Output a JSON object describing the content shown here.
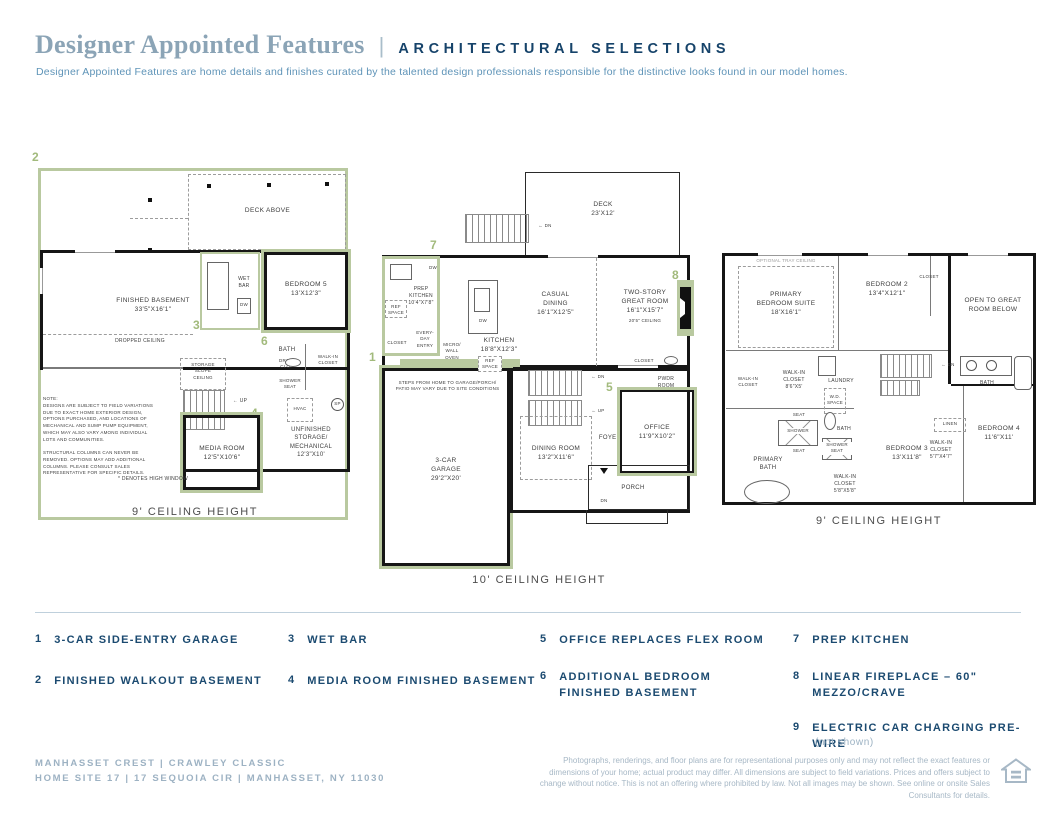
{
  "colors": {
    "accent_green": "#b9c9a0",
    "navy": "#1b4a70",
    "title_blue": "#8ba4b6",
    "footer_blue": "#9db2c3"
  },
  "header": {
    "title": "Designer Appointed Features",
    "separator": "|",
    "tagline": "ARCHITECTURAL SELECTIONS",
    "description": "Designer Appointed Features are home details and finishes curated by the talented design professionals responsible for the distinctive looks found in our model homes."
  },
  "basement": {
    "marker_finished_walkout": "2",
    "marker_wet_bar": "3",
    "marker_media_room": "4",
    "marker_bedroom": "6",
    "deck_above": "DECK ABOVE",
    "finished_basement": "FINISHED BASEMENT\n33'5\"X16'1\"",
    "dropped_ceiling": "DROPPED CEILING",
    "wet_bar": "WET\nBAR",
    "dw": "DW",
    "bedroom5": "BEDROOM 5\n13'X12'3\"",
    "bath": "BATH",
    "drop_clo": "DROP\nCLO.",
    "shower_seat": "SHOWER\nSEAT",
    "walk_in_closet": "WALK-IN\nCLOSET",
    "storage_slope_ceiling": "STORAGE\nSLOPE\nCEILING",
    "up": "← UP",
    "hvac": "HVAC",
    "sp": "SP",
    "unfinished": "UNFINISHED\nSTORAGE/\nMECHANICAL\n12'3\"X10'",
    "media_room": "MEDIA ROOM\n12'5\"X10'6\"",
    "note": "NOTE:\nDESIGNS ARE SUBJECT TO FIELD VARIATIONS\nDUE TO EXACT HOME EXTERIOR DESIGN,\nOPTIONS PURCHASED, AND LOCATIONS OF\nMECHANICAL AND SUMP PUMP EQUIPMENT,\nWHICH MAY ALSO VARY AMONG INDIVIDUAL\nLOTS AND COMMUNITIES.\n\nSTRUCTURAL COLUMNS CAN NEVER BE\nREMOVED. OPTIONS MAY ADD ADDITIONAL\nCOLUMNS. PLEASE CONSULT SALES\nREPRESENTATIVE FOR SPECIFIC DETAILS.",
    "high_window": "* DENOTES HIGH WINDOW",
    "ceiling_height": "9' CEILING HEIGHT"
  },
  "first_floor": {
    "marker_garage": "1",
    "marker_office": "5",
    "marker_prep_kitchen": "7",
    "marker_fireplace": "8",
    "deck": "DECK\n23'X12'",
    "dn": "← DN",
    "prep_kitchen": "PREP\nKITCHEN\n10'4\"X7'8\"",
    "ref_space": "REF\nSPACE",
    "dw": "DW",
    "casual_dining": "CASUAL\nDINING\n16'1\"X12'5\"",
    "great_room": "TWO-STORY\nGREAT ROOM\n16'1\"X15'7\"",
    "great_room_ceiling": "20'5\" CEILING",
    "closet": "CLOSET",
    "everyday_entry": "EVERY-\nDAY\nENTRY",
    "micro_wall_oven": "MICRO/\nWALL\nOVEN",
    "kitchen": "KITCHEN\n18'8\"X12'3\"",
    "steps_note": "STEPS FROM HOME TO GARAGE/PORCH/\nPATIO MAY VARY DUE TO SITE CONDITIONS",
    "garage": "3-CAR\nGARAGE\n29'2\"X20'",
    "up": "← UP",
    "dining_room": "DINING ROOM\n13'2\"X11'6\"",
    "foyer": "FOYER",
    "pwdr_room": "PWDR\nROOM",
    "office": "OFFICE\n11'9\"X10'2\"",
    "porch": "PORCH",
    "porch_dn": "DN",
    "ceiling_height": "10' CEILING HEIGHT"
  },
  "second_floor": {
    "optional_tray": "OPTIONAL TRAY CEILING",
    "primary_suite": "PRIMARY\nBEDROOM SUITE\n18'X16'1\"",
    "bedroom2": "BEDROOM 2\n13'4\"X12'1\"",
    "closet": "CLOSET",
    "open_to_great": "OPEN TO GREAT\nROOM BELOW",
    "dn": "← DN",
    "walk_in_closet": "WALK-IN\nCLOSET",
    "walk_in_closet_86": "WALK-IN\nCLOSET\n8'6\"X5'",
    "laundry": "LAUNDRY",
    "wd_space": "W.D.\nSPACE",
    "seat": "SEAT",
    "shower": "SHOWER",
    "bath": "BATH",
    "shower_seat": "SHOWER\nSEAT",
    "primary_bath": "PRIMARY\nBATH",
    "bedroom3": "BEDROOM 3\n13'X11'8\"",
    "walk_in_closet_58": "WALK-IN\nCLOSET\n5'8\"X5'8\"",
    "linen": "LINEN",
    "walk_in_closet_57": "WALK-IN\nCLOSET\n5'7\"X4'7\"",
    "bedroom4": "BEDROOM 4\n11'6\"X11'",
    "ceiling_height": "9' CEILING HEIGHT"
  },
  "features": [
    {
      "num": "1",
      "label": "3-CAR SIDE-ENTRY GARAGE"
    },
    {
      "num": "2",
      "label": "FINISHED WALKOUT BASEMENT"
    },
    {
      "num": "3",
      "label": "WET BAR"
    },
    {
      "num": "4",
      "label": "MEDIA ROOM FINISHED BASEMENT"
    },
    {
      "num": "5",
      "label": "OFFICE REPLACES FLEX ROOM"
    },
    {
      "num": "6",
      "label": "ADDITIONAL BEDROOM FINISHED BASEMENT"
    },
    {
      "num": "7",
      "label": "PREP KITCHEN"
    },
    {
      "num": "8",
      "label": "LINEAR FIREPLACE – 60\" MEZZO/CRAVE"
    },
    {
      "num": "9",
      "label": "ELECTRIC CAR CHARGING PRE-WIRE",
      "note": "(not shown)"
    }
  ],
  "footer": {
    "community": "MANHASSET CREST   |   CRAWLEY CLASSIC",
    "site": "HOME SITE 17   |   17 SEQUOIA CIR   |   MANHASSET, NY 11030",
    "disclaimer": "Photographs, renderings, and floor plans are for representational purposes only and may not reflect the exact features or dimensions of your home; actual product may differ. All dimensions are subject to field variations. Prices and offers subject to change without notice. This is not an offering where prohibited by law. Not all images may be shown. See online or onsite Sales Consultants for details."
  }
}
